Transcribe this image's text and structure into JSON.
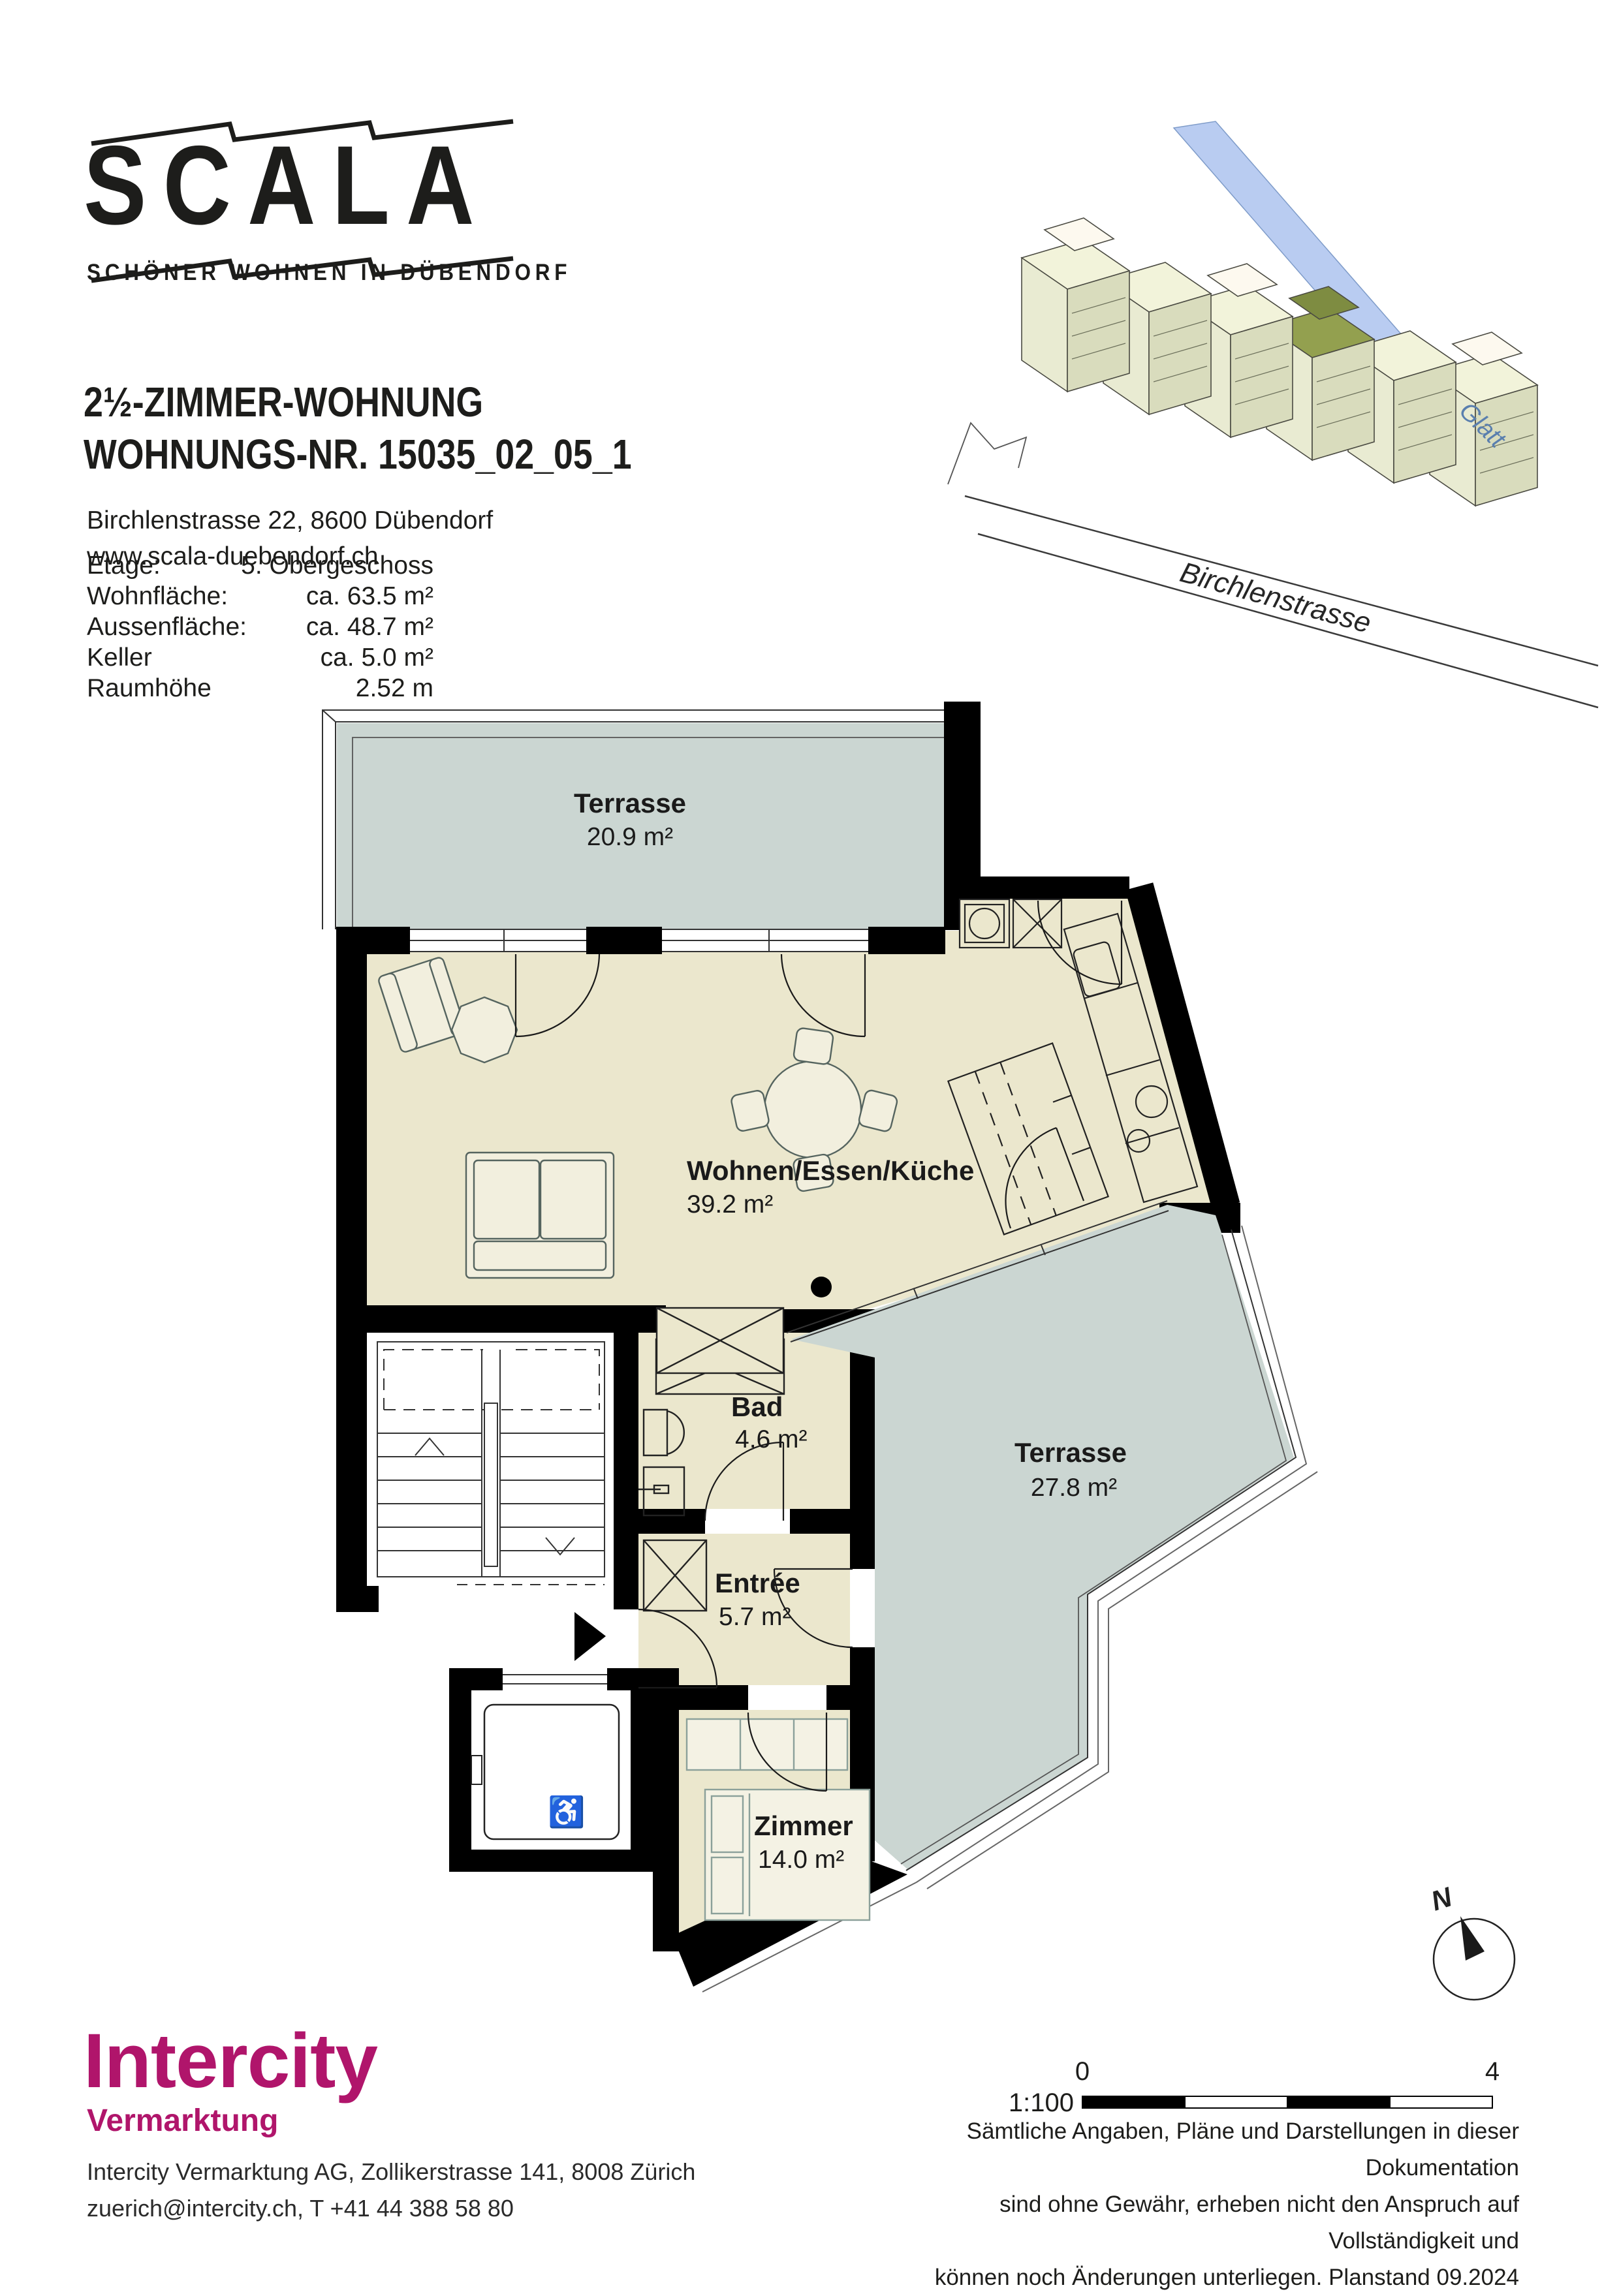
{
  "brand": {
    "logo": "SCALA",
    "tagline": "SCHÖNER WOHNEN IN DÜBENDORF"
  },
  "header": {
    "title_line1": "2½-ZIMMER-WOHNUNG",
    "title_line2": "WOHNUNGS-NR. 15035_02_05_1",
    "address": "Birchlenstrasse 22, 8600 Dübendorf",
    "website": "www.scala-duebendorf.ch"
  },
  "details": {
    "rows": [
      {
        "label": "Etage:",
        "value": "5. Obergeschoss"
      },
      {
        "label": "Wohnfläche:",
        "value": "ca. 63.5 m²"
      },
      {
        "label": "Aussenfläche:",
        "value": "ca. 48.7 m²"
      },
      {
        "label": "Keller",
        "value": "ca. 5.0 m²"
      },
      {
        "label": "Raumhöhe",
        "value": "2.52 m"
      }
    ]
  },
  "site_plan": {
    "street": "Birchlenstrasse",
    "river": "Glatt"
  },
  "floor_plan": {
    "rooms": [
      {
        "name": "Terrasse",
        "area": "20.9 m²"
      },
      {
        "name": "Wohnen/Essen/Küche",
        "area": "39.2 m²"
      },
      {
        "name": "Bad",
        "area": "4.6 m²"
      },
      {
        "name": "Entrée",
        "area": "5.7 m²"
      },
      {
        "name": "Terrasse",
        "area": "27.8 m²"
      },
      {
        "name": "Zimmer",
        "area": "14.0 m²"
      }
    ],
    "compass_label": "N",
    "scale": {
      "ratio": "1:100",
      "start": "0",
      "end": "4"
    }
  },
  "footer": {
    "logo": "Intercity",
    "sub": "Vermarktung",
    "address_line1": "Intercity Vermarktung AG, Zollikerstrasse 141, 8008 Zürich",
    "address_line2": "zuerich@intercity.ch, T +41 44 388 58 80",
    "disclaimer_line1": "Sämtliche Angaben, Pläne und Darstellungen in dieser Dokumentation",
    "disclaimer_line2": "sind ohne Gewähr, erheben nicht den Anspruch auf Vollständigkeit und",
    "disclaimer_line3": "können noch Änderungen unterliegen. Planstand 09.2024"
  }
}
